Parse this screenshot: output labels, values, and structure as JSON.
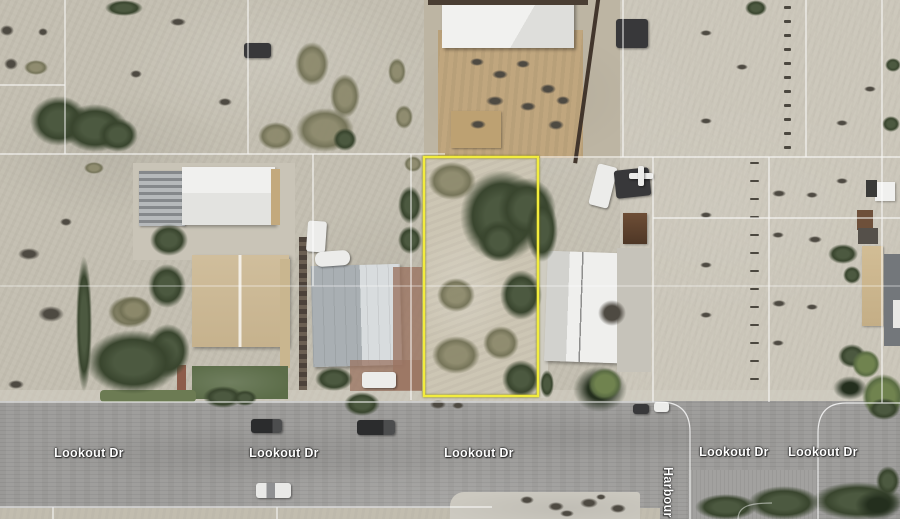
{
  "map": {
    "imagery_type": "satellite",
    "street_labels": {
      "lookout": "Lookout Dr",
      "cross_street": "Harbour"
    }
  },
  "overlay": {
    "highlighted_parcel_color": "#f2ec3d",
    "boundary_line_color": "#ffffff",
    "label_text_color": "#ffffff"
  }
}
